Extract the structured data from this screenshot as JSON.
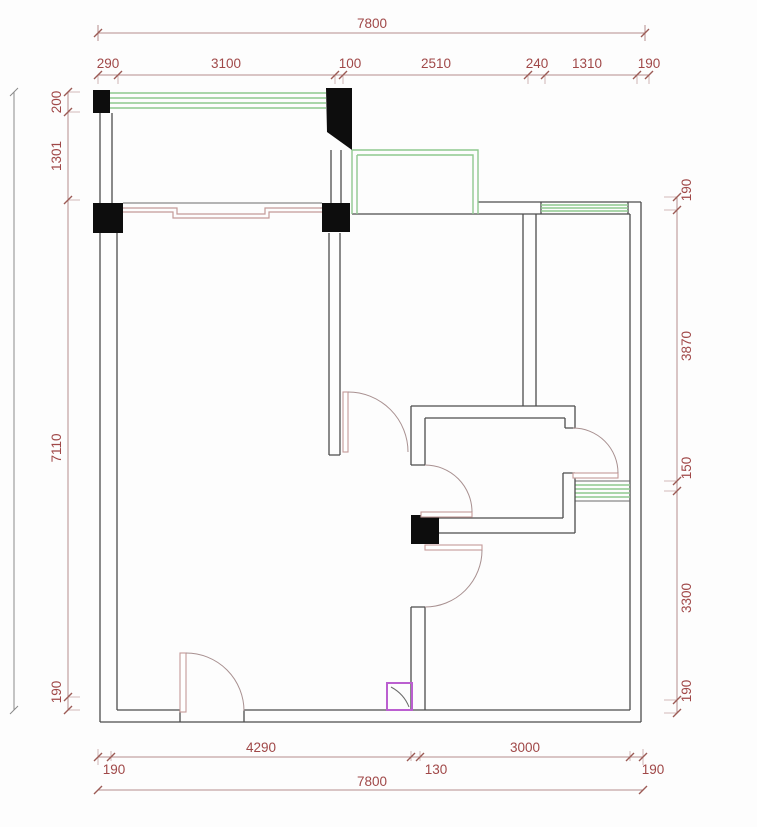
{
  "meta": {
    "type": "architectural-floor-plan",
    "units": "mm"
  },
  "colors": {
    "background": "#fdfdfd",
    "wall": "#4d4d4d",
    "column": "#0d0d0d",
    "window_glass": "#8fc98f",
    "door_leaf": "#c49a98",
    "door_arc": "#a89090",
    "dimension_line": "#b58d8d",
    "dimension_text": "#a04848",
    "highlight_box": "#bb5fd0"
  },
  "dimensions": {
    "top": {
      "overall": "7800",
      "segments": [
        "290",
        "3100",
        "100",
        "2510",
        "240",
        "1310",
        "190"
      ]
    },
    "bottom": {
      "overall": "7800",
      "segments": [
        "190",
        "4290",
        "130",
        "3000",
        "190"
      ]
    },
    "left": {
      "segments": [
        "200",
        "1301",
        "7110",
        "190"
      ]
    },
    "right": {
      "segments": [
        "190",
        "3870",
        "150",
        "3300",
        "190"
      ]
    }
  }
}
